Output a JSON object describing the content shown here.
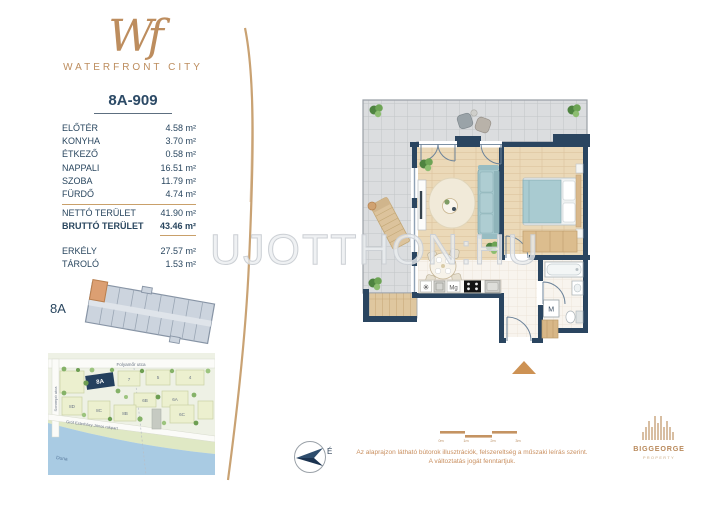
{
  "brand": {
    "monogram": "Wf",
    "name": "WATERFRONT CITY"
  },
  "unit_id": "8A-909",
  "areas": {
    "rooms": [
      {
        "label": "ELŐTÉR",
        "value": "4.58 m²"
      },
      {
        "label": "KONYHA",
        "value": "3.70 m²"
      },
      {
        "label": "ÉTKEZŐ",
        "value": "0.58 m²"
      },
      {
        "label": "NAPPALI",
        "value": "16.51 m²"
      },
      {
        "label": "SZOBA",
        "value": "11.79 m²"
      },
      {
        "label": "FÜRDŐ",
        "value": "4.74 m²"
      }
    ],
    "totals": [
      {
        "label": "NETTÓ TERÜLET",
        "value": "41.90 m²"
      },
      {
        "label": "BRUTTÓ TERÜLET",
        "value": "43.46 m²"
      }
    ],
    "extras": [
      {
        "label": "ERKÉLY",
        "value": "27.57 m²"
      },
      {
        "label": "TÁROLÓ",
        "value": "1.53 m²"
      }
    ]
  },
  "building": {
    "label": "8A"
  },
  "map": {
    "streets": {
      "top": "Folyamőr utca",
      "left": "Sorompó utca",
      "quay": "Gróf Esterházy János rakpart",
      "river": "Duna"
    },
    "highlight": "8A",
    "blocks": [
      "7",
      "5",
      "4",
      "6B",
      "6A",
      "8D",
      "8C",
      "8B",
      "6C"
    ]
  },
  "floorplan": {
    "appliances": {
      "fridge_icon": "✳",
      "microwave_label": "Mg",
      "washer_label": "M"
    }
  },
  "compass": {
    "label": "É"
  },
  "scalebar": {
    "labels": [
      "0m",
      "1m",
      "2m",
      "3m"
    ]
  },
  "disclaimer": {
    "line1": "Az alaprajzon látható bútorok illusztrációk, felszereltség a műszaki leírás szerint.",
    "line2": "A változtatás jogát fenntartjuk."
  },
  "watermark": "UJOTTHON:HU",
  "developer": {
    "name": "BIGGEORGE",
    "subtitle": "PROPERTY"
  },
  "colors": {
    "accent_tan": "#C08B5C",
    "navy_text": "#29465F",
    "wall_navy": "#2A4560",
    "highlight_unit": "#DC9F72",
    "water_blue": "#A9CBE3"
  }
}
